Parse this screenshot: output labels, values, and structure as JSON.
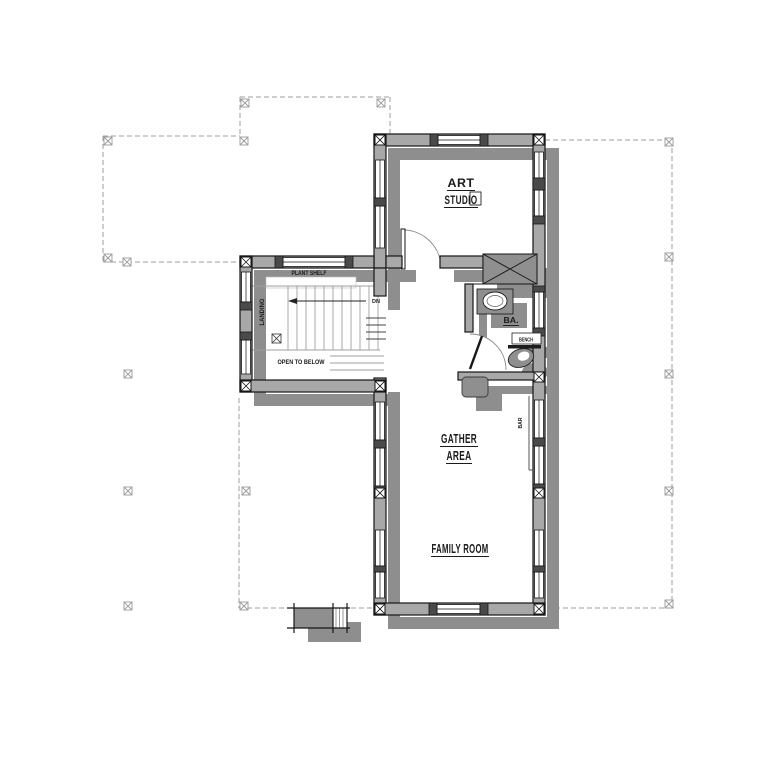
{
  "drawing": {
    "type": "floor-plan",
    "labels": {
      "art_studio_line1": "ART",
      "art_studio_line2": "STUDIO",
      "gather_line1": "GATHER",
      "gather_line2": "AREA",
      "family_room": "FAMILY ROOM",
      "plant_shelf": "PLANT SHELF",
      "landing": "LANDING",
      "down": "DN",
      "open_to_below": "OPEN TO BELOW",
      "bath": "BA.",
      "bench": "BENCH",
      "bar": "BAR"
    },
    "colors": {
      "background": "#ffffff",
      "shadow": "#8e8e8e",
      "wall_fill": "#a8a8a8",
      "wall_line": "#161616",
      "post_fill": "#4a4a4a",
      "fixture_fill": "#8f8f8f",
      "dashed_line": "#9e9e9e",
      "marker": "#9a9a9a",
      "stair_line": "#9f9f9f",
      "text": "#1a1a1a"
    }
  }
}
